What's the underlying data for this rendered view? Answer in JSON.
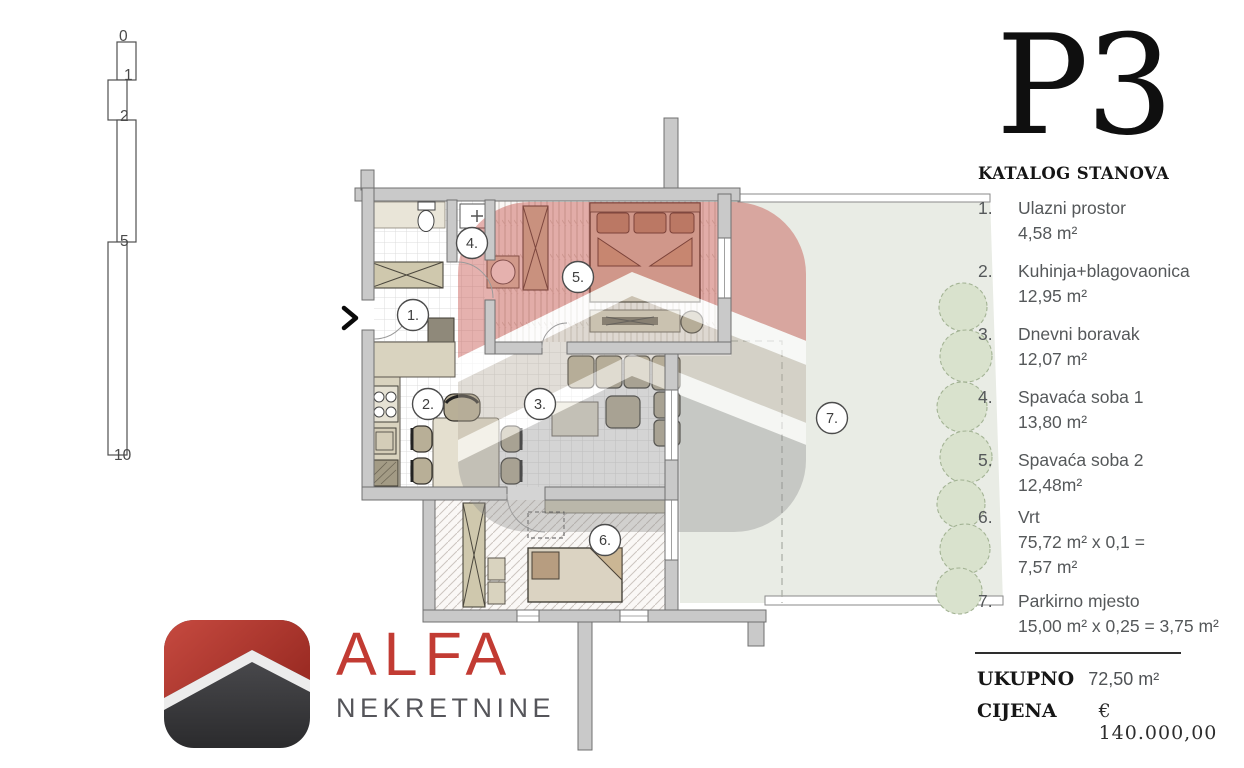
{
  "title": "P3",
  "catalog_heading": "KATALOG STANOVA",
  "items": [
    {
      "num": "1.",
      "name": "Ulazni prostor",
      "area": "4,58 m²"
    },
    {
      "num": "2.",
      "name": "Kuhinja+blagovaonica",
      "area": "12,95 m²"
    },
    {
      "num": "3.",
      "name": "Dnevni boravak",
      "area": "12,07 m²"
    },
    {
      "num": "4.",
      "name": "Spavaća soba 1",
      "area": "13,80 m²"
    },
    {
      "num": "5.",
      "name": "Spavaća soba 2",
      "area": "12,48m²"
    },
    {
      "num": "6.",
      "name": "Vrt",
      "area": "75,72 m² x 0,1 =",
      "area2": "7,57 m²"
    },
    {
      "num": "7.",
      "name": "Parkirno mjesto",
      "area": "15,00 m² x 0,25 = 3,75 m²"
    }
  ],
  "summary": {
    "total_label": "UKUPNO",
    "total_value": "72,50 m²",
    "price_label": "CIJENA",
    "price_value": "€ 140.000,00"
  },
  "logo": {
    "name": "ALFA",
    "subtitle": "NEKRETNINE"
  },
  "scalebar": {
    "labels": [
      "0",
      "1",
      "2",
      "5",
      "10"
    ]
  },
  "plan": {
    "room_labels": [
      "1.",
      "2.",
      "3.",
      "4.",
      "5.",
      "6.",
      "7."
    ]
  },
  "colors": {
    "accent_red": "#c23b33",
    "wall_gray": "#c9c9c9",
    "garden_green": "#e9ece5",
    "tree_green": "#d9e2cd",
    "text_gray": "#55585a"
  }
}
